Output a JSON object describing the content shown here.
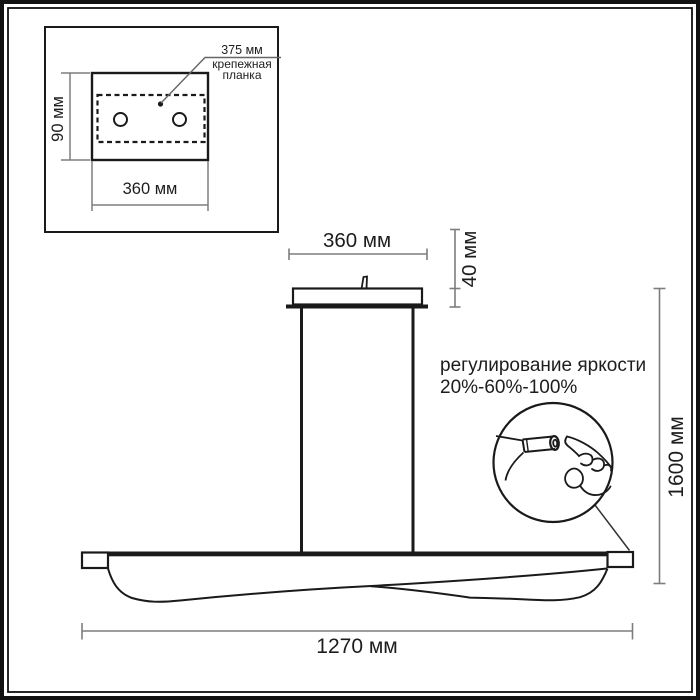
{
  "diagram_type": "pendant-lamp-dimension-drawing",
  "inset": {
    "plate_width_label": "375 мм",
    "plate_name_line1": "крепежная",
    "plate_name_line2": "планка",
    "height_label": "90 мм",
    "width_label": "360 мм"
  },
  "canopy": {
    "width_label": "360 мм",
    "height_label": "40 мм"
  },
  "overall": {
    "height_label": "1600 мм",
    "length_label": "1270 мм"
  },
  "brightness_note": {
    "line1": "регулирование яркости",
    "line2": "20%-60%-100%"
  },
  "colors": {
    "drawing_line": "#1a1a1a",
    "dimension_line": "#7d7d7d",
    "leader_line": "#666666",
    "text": "#1d1d1d",
    "background": "#ffffff"
  }
}
